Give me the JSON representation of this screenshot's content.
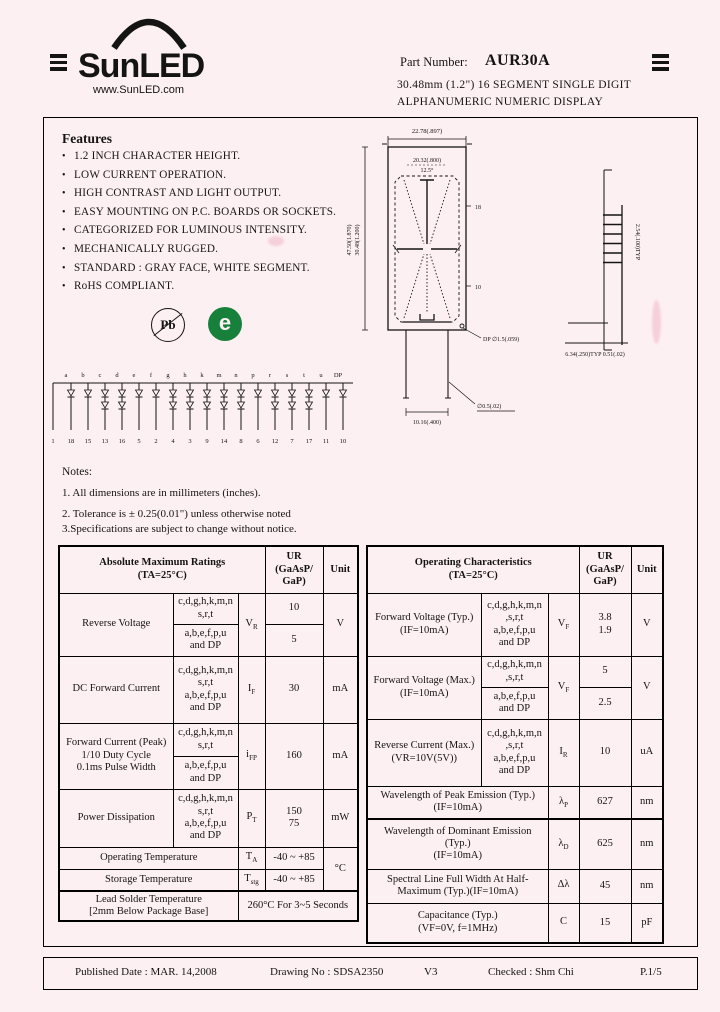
{
  "header": {
    "brand": "SunLED",
    "website": "www.SunLED.com",
    "part_number_label": "Part Number:",
    "part_number": "AUR30A",
    "description_line1": "30.48mm (1.2\") 16 SEGMENT  SINGLE  DIGIT",
    "description_line2": "ALPHANUMERIC  NUMERIC  DISPLAY"
  },
  "features": {
    "title": "Features",
    "items": [
      "1.2 INCH CHARACTER HEIGHT.",
      "LOW CURRENT OPERATION.",
      "HIGH CONTRAST AND LIGHT OUTPUT.",
      "EASY MOUNTING ON P.C. BOARDS OR SOCKETS.",
      "CATEGORIZED FOR LUMINOUS INTENSITY.",
      "MECHANICALLY RUGGED.",
      "STANDARD : GRAY FACE, WHITE SEGMENT.",
      "RoHS COMPLIANT."
    ]
  },
  "compliance": {
    "pb_free": "Pb",
    "green_mark": "e"
  },
  "drawing": {
    "labels": {
      "top_width": "22.78(.897)",
      "inner_width": "20.32(.800)",
      "slant_angle": "12.5°",
      "outer_height": "47.50(1.870)",
      "left_height": "30.48(1.200)",
      "pin_ref_top": "18",
      "pin_ref_bottom": "10",
      "dp_label": "DP ∅1.5(.059)",
      "lead_span": "10.16(.400)",
      "lead_dia": "∅0.5(.02)",
      "side_pitch": "2.54(.100)TYP",
      "side_bottom": "6.34(.250)TYP 0.51(.02)"
    }
  },
  "circuit": {
    "segments": [
      "a",
      "b",
      "c",
      "d",
      "e",
      "f",
      "g",
      "h",
      "k",
      "m",
      "n",
      "p",
      "r",
      "s",
      "t",
      "u",
      "DP"
    ],
    "pins": [
      "1",
      "18",
      "15",
      "13",
      "16",
      "5",
      "2",
      "4",
      "3",
      "9",
      "14",
      "8",
      "6",
      "12",
      "7",
      "17",
      "11",
      "10"
    ],
    "doubled": [
      2,
      3,
      6,
      7,
      8,
      9,
      10,
      12,
      13,
      14
    ]
  },
  "notes": {
    "title": "Notes:",
    "item1": "1. All dimensions are in millimeters (inches).",
    "item2": "2. Tolerance is ± 0.25(0.01\") unless otherwise noted",
    "item3": "3.Specifications are subject to change without notice."
  },
  "amr": {
    "title": "Absolute Maximum Ratings",
    "condition": "(TA=25°C)",
    "col_ur_1": "UR",
    "col_ur_2": "(GaAsP/",
    "col_ur_3": "GaP)",
    "col_unit": "Unit",
    "group_a": "c,d,g,h,k,m,n",
    "group_a2": "s,r,t",
    "group_b": "a,b,e,f,p,u",
    "group_b2": "and DP",
    "reverse_voltage": {
      "param": "Reverse Voltage",
      "sym": "V",
      "sub": "R",
      "v1": "10",
      "v2": "5",
      "unit": "V"
    },
    "dc_forward_current": {
      "param": "DC Forward Current",
      "sym": "I",
      "sub": "F",
      "value": "30",
      "unit": "mA"
    },
    "peak_forward_current": {
      "param1": "Forward Current (Peak)",
      "param2": "1/10 Duty Cycle",
      "param3": "0.1ms Pulse Width",
      "sym": "i",
      "sub": "FP",
      "value": "160",
      "unit": "mA"
    },
    "power_dissipation": {
      "param": "Power Dissipation",
      "sym": "P",
      "sub": "T",
      "v1": "150",
      "v2": "75",
      "unit": "mW"
    },
    "operating_temperature": {
      "param": "Operating Temperature",
      "sym": "T",
      "sub": "A",
      "value": "-40 ~ +85"
    },
    "storage_temperature": {
      "param": "Storage Temperature",
      "sym": "T",
      "sub": "stg",
      "value": "-40 ~ +85",
      "unit": "°C"
    },
    "lead_solder": {
      "param1": "Lead Solder Temperature",
      "param2": "[2mm Below  Package Base]",
      "value": "260°C  For 3~5 Seconds"
    }
  },
  "oc": {
    "title": "Operating Characteristics",
    "condition": "(TA=25°C)",
    "col_ur_1": "UR",
    "col_ur_2": "(GaAsP/",
    "col_ur_3": "GaP)",
    "col_unit": "Unit",
    "group_a": "c,d,g,h,k,m,n",
    "group_a2": ",s,r,t",
    "group_b": "a,b,e,f,p,u",
    "group_b2": "and DP",
    "fv_typ": {
      "param1": "Forward Voltage (Typ.)",
      "param2": "(IF=10mA)",
      "sym": "V",
      "sub": "F",
      "v1": "3.8",
      "v2": "1.9",
      "unit": "V"
    },
    "fv_max": {
      "param1": "Forward Voltage (Max.)",
      "param2": "(IF=10mA)",
      "sym": "V",
      "sub": "F",
      "v1": "5",
      "v2": "2.5",
      "unit": "V"
    },
    "reverse_current": {
      "param1": "Reverse Current (Max.)",
      "param2": "(VR=10V(5V))",
      "sym": "I",
      "sub": "R",
      "value": "10",
      "unit": "uA"
    },
    "peak_wavelength": {
      "param1": "Wavelength of Peak Emission (Typ.)",
      "param2": "(IF=10mA)",
      "sym": "λ",
      "sub": "P",
      "value": "627",
      "unit": "nm"
    },
    "dominant_wavelength": {
      "param1": "Wavelength of Dominant Emission",
      "param2": "(Typ.)",
      "param3": "(IF=10mA)",
      "sym": "λ",
      "sub": "D",
      "value": "625",
      "unit": "nm"
    },
    "spectral_width": {
      "param1": "Spectral Line Full Width At Half-",
      "param2": "Maximum (Typ.)(IF=10mA)",
      "sym": "Δλ",
      "sub": "",
      "value": "45",
      "unit": "nm"
    },
    "capacitance": {
      "param1": "Capacitance (Typ.)",
      "param2": "(VF=0V, f=1MHz)",
      "sym": "C",
      "sub": "",
      "value": "15",
      "unit": "pF"
    }
  },
  "footer": {
    "published": "Published Date : MAR. 14,2008",
    "drawing_no": "Drawing No : SDSA2350",
    "version": "V3",
    "checked": "Checked : Shm  Chi",
    "page": "P.1/5"
  }
}
